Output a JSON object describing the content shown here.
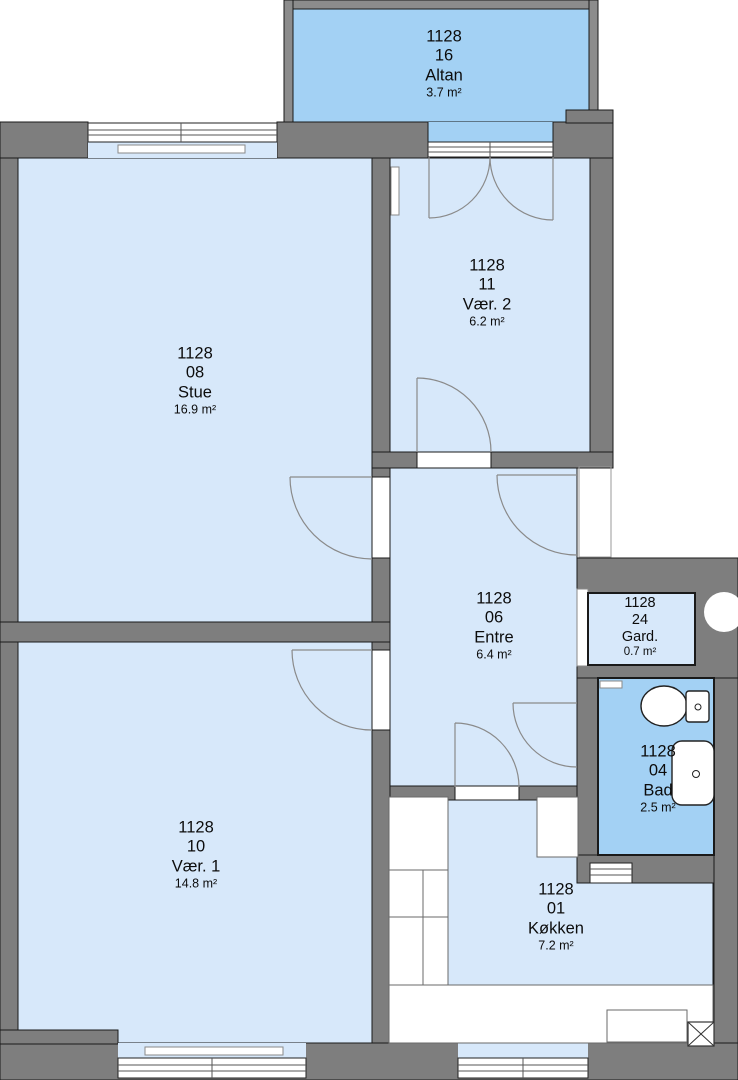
{
  "colors": {
    "wall": "#7e7e7e",
    "parapet": "#8c8c8c",
    "room": "#d7e8fa",
    "wet": "#a3d1f4",
    "outline": "#1a1a1a",
    "door": "#8a8a8a"
  },
  "rooms": [
    {
      "id": "altan",
      "code": "1128",
      "unit": "16",
      "name": "Altan",
      "area": "3.7 m²"
    },
    {
      "id": "vaer2",
      "code": "1128",
      "unit": "11",
      "name": "Vær. 2",
      "area": "6.2 m²"
    },
    {
      "id": "stue",
      "code": "1128",
      "unit": "08",
      "name": "Stue",
      "area": "16.9 m²"
    },
    {
      "id": "entre",
      "code": "1128",
      "unit": "06",
      "name": "Entre",
      "area": "6.4 m²"
    },
    {
      "id": "gard",
      "code": "1128",
      "unit": "24",
      "name": "Gard.",
      "area": "0.7 m²"
    },
    {
      "id": "bad",
      "code": "1128",
      "unit": "04",
      "name": "Bad",
      "area": "2.5 m²"
    },
    {
      "id": "koekken",
      "code": "1128",
      "unit": "01",
      "name": "Køkken",
      "area": "7.2 m²"
    },
    {
      "id": "vaer1",
      "code": "1128",
      "unit": "10",
      "name": "Vær. 1",
      "area": "14.8 m²"
    }
  ],
  "fixtures": [
    "toilet",
    "sink",
    "radiator",
    "kitchen-counter",
    "refrigerator",
    "shaft-box",
    "pipe-chase-circle",
    "wall-vent"
  ]
}
